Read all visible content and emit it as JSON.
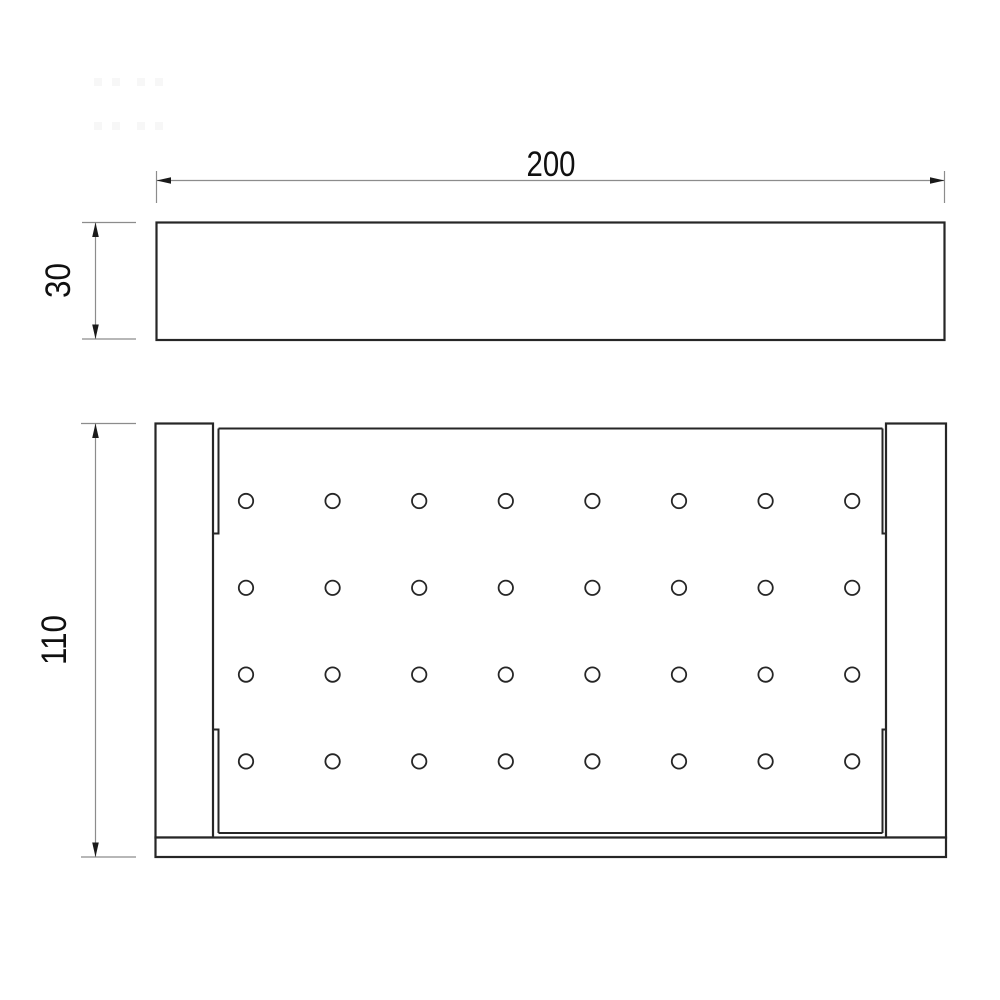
{
  "drawing": {
    "labels": {
      "width": "200",
      "depth": "30",
      "height": "110"
    },
    "holes": {
      "rows": 4,
      "cols": 8
    },
    "colors": {
      "outline": "#262626",
      "dimension": "#8c8c8c",
      "text": "#101010",
      "background": "#ffffff"
    }
  }
}
